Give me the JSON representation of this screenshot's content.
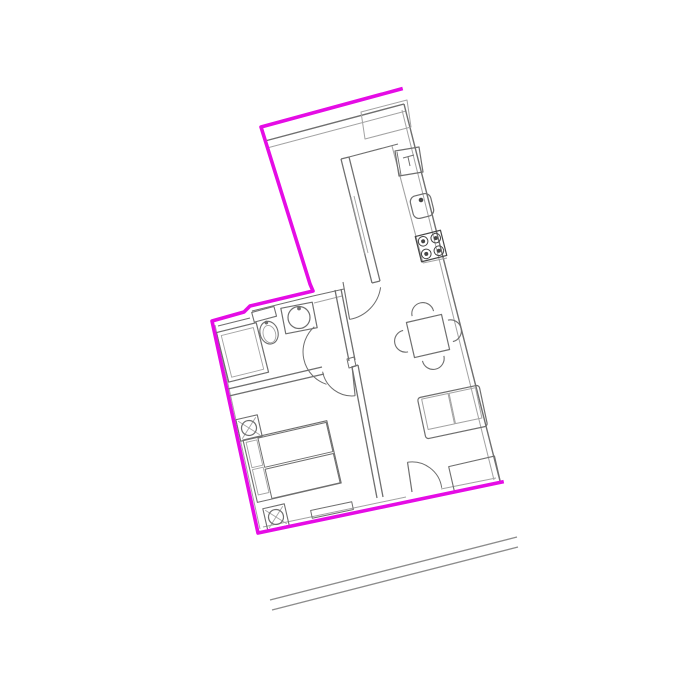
{
  "canvas": {
    "width": 700,
    "height": 700,
    "background": "#ffffff"
  },
  "palette": {
    "boundary": "#e50ce5",
    "wall": "#6f6f6f",
    "light": "#a3a3a3",
    "detail": "#454545",
    "road": "#8c8c8c"
  },
  "drawing_title": "Apartment floor plan",
  "shapes": [
    {
      "n": "road-line-outer",
      "t": "line",
      "p": [
        270,
        600,
        517,
        537
      ],
      "c": "road",
      "w": 1.4
    },
    {
      "n": "road-line-inner",
      "t": "line",
      "p": [
        272,
        610,
        518,
        547
      ],
      "c": "road",
      "w": 1.4
    },
    {
      "n": "top-wall-inner-dark",
      "t": "line",
      "p": [
        265,
        141,
        404,
        104
      ],
      "c": "wall",
      "w": 1.4
    },
    {
      "n": "top-wall-inner-light",
      "t": "line",
      "p": [
        267,
        148,
        406,
        111
      ],
      "c": "light",
      "w": 1
    },
    {
      "n": "upper-left-wall-inner",
      "t": "line",
      "p": [
        266,
        144,
        312,
        287
      ],
      "c": "light",
      "w": 1
    },
    {
      "n": "right-wall-outer",
      "t": "line",
      "p": [
        404,
        104,
        500,
        481
      ],
      "c": "wall",
      "w": 1.4
    },
    {
      "n": "right-wall-inner",
      "t": "line",
      "p": [
        402,
        110,
        494,
        480
      ],
      "c": "light",
      "w": 1
    },
    {
      "n": "bottom-wall-inner-left",
      "t": "line",
      "p": [
        263,
        527,
        406,
        497
      ],
      "c": "light",
      "w": 1
    },
    {
      "n": "bottom-wall-inner-right",
      "t": "line",
      "p": [
        441,
        489,
        496,
        478
      ],
      "c": "light",
      "w": 1
    },
    {
      "n": "left-wall-inner",
      "t": "line",
      "p": [
        215,
        325,
        260,
        529
      ],
      "c": "light",
      "w": 1
    },
    {
      "n": "bathroom-top-wall-inner",
      "t": "line",
      "p": [
        252,
        311,
        313,
        296
      ],
      "c": "wall",
      "w": 1
    },
    {
      "n": "bathroom-top-wall-inner-left",
      "t": "line",
      "p": [
        218,
        326,
        250,
        318
      ],
      "c": "wall",
      "w": 1
    },
    {
      "n": "bathroom-top-wall-east",
      "t": "line",
      "p": [
        313,
        296,
        344,
        289
      ],
      "c": "wall",
      "w": 1
    },
    {
      "n": "bathroom-top-wall-east-2",
      "t": "line",
      "p": [
        314,
        303,
        342,
        296
      ],
      "c": "light",
      "w": 1
    },
    {
      "n": "bathroom-east-wall-1",
      "t": "line",
      "p": [
        335,
        290,
        349,
        361
      ],
      "c": "wall",
      "w": 1.3
    },
    {
      "n": "bathroom-east-wall-2",
      "t": "line",
      "p": [
        341,
        289,
        355,
        360
      ],
      "c": "wall",
      "w": 1.3
    },
    {
      "n": "kitchen-wall-west",
      "t": "line",
      "p": [
        341,
        159,
        372,
        283
      ],
      "c": "wall",
      "w": 1.3
    },
    {
      "n": "kitchen-wall-east",
      "t": "line",
      "p": [
        349,
        157,
        380,
        281
      ],
      "c": "wall",
      "w": 1.3
    },
    {
      "n": "kitchen-wall-cap-top",
      "t": "line",
      "p": [
        341,
        159,
        349,
        157
      ],
      "c": "wall",
      "w": 1.3
    },
    {
      "n": "kitchen-wall-cap-bottom",
      "t": "line",
      "p": [
        372,
        283,
        380,
        281
      ],
      "c": "wall",
      "w": 1.3
    },
    {
      "n": "kitchen-wall-hatch-1",
      "t": "line",
      "p": [
        351,
        197,
        365,
        254
      ],
      "c": "light",
      "w": 0.9
    },
    {
      "n": "kitchen-wall-hatch-2",
      "t": "line",
      "p": [
        354,
        196,
        368,
        253
      ],
      "c": "light",
      "w": 0.9
    },
    {
      "n": "kitchen-counter-back-line",
      "t": "line",
      "p": [
        349,
        157,
        398,
        144
      ],
      "c": "wall",
      "w": 1.1
    },
    {
      "n": "kitchen-tall-unit",
      "t": "polygon",
      "pts": "361,112 407,100 411,127 365,139",
      "c": "light",
      "w": 1
    },
    {
      "n": "kitchen-counter-front",
      "t": "line",
      "p": [
        392,
        146,
        423,
        263
      ],
      "c": "light",
      "w": 1.1
    },
    {
      "n": "kitchen-counter-cap",
      "t": "line",
      "p": [
        423,
        263,
        447,
        258
      ],
      "c": "light",
      "w": 1.1
    },
    {
      "n": "appliance-boiler",
      "t": "polygon",
      "pts": "395,151 419,147 423,172 399,176",
      "c": "wall",
      "w": 1.2
    },
    {
      "n": "boiler-door-edge",
      "t": "line",
      "p": [
        397,
        152,
        401,
        175
      ],
      "c": "wall",
      "w": 0.9
    },
    {
      "n": "boiler-symbol-1",
      "t": "line",
      "p": [
        403,
        158,
        414,
        155
      ],
      "c": "wall",
      "w": 1
    },
    {
      "n": "boiler-symbol-2",
      "t": "line",
      "p": [
        408,
        157,
        410,
        166
      ],
      "c": "wall",
      "w": 1
    },
    {
      "n": "kitchen-sink",
      "t": "rect",
      "x": 411.5,
      "y": 194.5,
      "wd": 21,
      "h": 23,
      "rx": 6,
      "tr": "rotate(-14 422 206)",
      "c": "wall",
      "w": 1.2
    },
    {
      "n": "kitchen-sink-faucet",
      "t": "circle",
      "cx": 421,
      "cy": 200,
      "r": 1.8,
      "c": "detail",
      "w": 1,
      "f": "detail"
    },
    {
      "n": "stove",
      "t": "rect",
      "x": 418,
      "y": 233,
      "wd": 26,
      "h": 26,
      "tr": "rotate(-14 431 246)",
      "c": "detail",
      "w": 1.2
    },
    {
      "n": "stove-burner-1",
      "t": "circle",
      "cx": 424.5,
      "cy": 239.5,
      "r": 4.8,
      "tr": "rotate(-14 431 246)",
      "c": "detail",
      "w": 1
    },
    {
      "n": "stove-burner-2",
      "t": "circle",
      "cx": 437.5,
      "cy": 239.5,
      "r": 4.8,
      "tr": "rotate(-14 431 246)",
      "c": "detail",
      "w": 1
    },
    {
      "n": "stove-burner-3",
      "t": "circle",
      "cx": 424.5,
      "cy": 252.5,
      "r": 4.8,
      "tr": "rotate(-14 431 246)",
      "c": "detail",
      "w": 1
    },
    {
      "n": "stove-burner-4",
      "t": "circle",
      "cx": 437.5,
      "cy": 252.5,
      "r": 4.8,
      "tr": "rotate(-14 431 246)",
      "c": "detail",
      "w": 1
    },
    {
      "n": "stove-burner-dot-1",
      "t": "circle",
      "cx": 424.5,
      "cy": 239.5,
      "r": 1.6,
      "tr": "rotate(-14 431 246)",
      "c": "detail",
      "w": 0.8,
      "f": "detail"
    },
    {
      "n": "stove-burner-dot-2",
      "t": "circle",
      "cx": 437.5,
      "cy": 239.5,
      "r": 1.6,
      "tr": "rotate(-14 431 246)",
      "c": "detail",
      "w": 0.8,
      "f": "detail"
    },
    {
      "n": "stove-burner-dot-3",
      "t": "circle",
      "cx": 424.5,
      "cy": 252.5,
      "r": 1.6,
      "tr": "rotate(-14 431 246)",
      "c": "detail",
      "w": 0.8,
      "f": "detail"
    },
    {
      "n": "stove-burner-dot-4",
      "t": "circle",
      "cx": 437.5,
      "cy": 252.5,
      "r": 1.6,
      "tr": "rotate(-14 431 246)",
      "c": "detail",
      "w": 0.8,
      "f": "detail"
    },
    {
      "n": "hall-door-leaf",
      "t": "line",
      "p": [
        343,
        282,
        349.6,
        319.4
      ],
      "c": "wall",
      "w": 1.1
    },
    {
      "n": "hall-door-arc",
      "t": "path",
      "d": "M349.6,319.4 A38,38 0 0 0 380.6,287.3",
      "c": "wall",
      "w": 1
    },
    {
      "n": "bathroom-door-arc",
      "t": "path",
      "d": "M314.3,326.7 A34,34 0 0 0 326.5,384.3",
      "c": "wall",
      "w": 1
    },
    {
      "n": "bedroom-top-wall-1",
      "t": "line",
      "p": [
        228,
        389,
        322,
        367
      ],
      "c": "wall",
      "w": 1.3
    },
    {
      "n": "bedroom-top-wall-2",
      "t": "line",
      "p": [
        229,
        396,
        324,
        374
      ],
      "c": "wall",
      "w": 1.3
    },
    {
      "n": "bedroom-door-post",
      "t": "polygon",
      "pts": "347,359 354,357 356,366 349,368",
      "c": "wall",
      "w": 1
    },
    {
      "n": "bedroom-door-arc",
      "t": "path",
      "d": "M322.6,371.7 A30,30 0 0 0 355.1,395.8",
      "c": "wall",
      "w": 1
    },
    {
      "n": "bedroom-door-leaf",
      "t": "line",
      "p": [
        352,
        366,
        355.1,
        395.8
      ],
      "c": "wall",
      "w": 1.1
    },
    {
      "n": "bedroom-living-wall-1",
      "t": "line",
      "p": [
        352,
        367,
        377,
        498
      ],
      "c": "wall",
      "w": 1.3
    },
    {
      "n": "bedroom-living-wall-2",
      "t": "line",
      "p": [
        358,
        365,
        383,
        497
      ],
      "c": "wall",
      "w": 1.3
    },
    {
      "n": "bedroom-living-wall-cap",
      "t": "line",
      "p": [
        352,
        367,
        358,
        365
      ],
      "c": "wall",
      "w": 1.3
    },
    {
      "n": "shower-outer",
      "t": "rect",
      "x": 222,
      "y": 327,
      "wd": 41,
      "h": 51,
      "tr": "rotate(-14 242 352.5)",
      "c": "wall",
      "w": 1.2
    },
    {
      "n": "shower-inner",
      "t": "rect",
      "x": 226,
      "y": 331,
      "wd": 33,
      "h": 43,
      "tr": "rotate(-14 242 352.5)",
      "c": "light",
      "w": 0.9
    },
    {
      "n": "toilet-tank",
      "t": "rect",
      "x": 256,
      "y": 309,
      "wd": 23,
      "h": 10,
      "tr": "rotate(-15 267 327)",
      "c": "wall",
      "w": 1.1
    },
    {
      "n": "toilet-flush-dot",
      "t": "circle",
      "cx": 267.5,
      "cy": 322.5,
      "r": 1.5,
      "tr": "rotate(-15 267 327)",
      "c": "wall",
      "w": 0.8,
      "f": "wall"
    },
    {
      "n": "toilet-bowl",
      "t": "ellipse",
      "cx": 267.5,
      "cy": 333,
      "rx": 9,
      "ry": 11.5,
      "tr": "rotate(-15 267 327)",
      "c": "wall",
      "w": 1.1
    },
    {
      "n": "toilet-bowl-inner",
      "t": "ellipse",
      "cx": 267.5,
      "cy": 334.5,
      "rx": 6.2,
      "ry": 8.8,
      "tr": "rotate(-15 267 327)",
      "c": "light",
      "w": 0.9
    },
    {
      "n": "bath-sink-box",
      "t": "rect",
      "x": 283,
      "y": 305,
      "wd": 32,
      "h": 26,
      "tr": "rotate(-11 299 318)",
      "c": "wall",
      "w": 1.2
    },
    {
      "n": "bath-sink-basin",
      "t": "circle",
      "cx": 299,
      "cy": 317.5,
      "r": 11,
      "c": "wall",
      "w": 1.2
    },
    {
      "n": "bath-sink-faucet",
      "t": "circle",
      "cx": 299,
      "cy": 308.5,
      "r": 1.5,
      "c": "wall",
      "w": 0.8,
      "f": "wall"
    },
    {
      "n": "dining-table",
      "t": "rect",
      "x": 410,
      "y": 318,
      "wd": 36,
      "h": 36,
      "tr": "rotate(-13 428 336)",
      "c": "wall",
      "w": 1.2
    },
    {
      "n": "chair-north",
      "t": "path",
      "d": "M417,313 A11,11 0 0 1 439,313",
      "tr": "rotate(-13 428 336)",
      "c": "wall",
      "w": 1.1
    },
    {
      "n": "chair-south",
      "t": "path",
      "d": "M439,359 A11,11 0 0 1 417,359",
      "tr": "rotate(-13 428 336)",
      "c": "wall",
      "w": 1.1
    },
    {
      "n": "chair-west",
      "t": "path",
      "d": "M405,347 A11,11 0 0 1 405,325",
      "tr": "rotate(-13 428 336)",
      "c": "wall",
      "w": 1.1
    },
    {
      "n": "chair-east",
      "t": "path",
      "d": "M451,325 A11,11 0 0 1 451,347",
      "tr": "rotate(-13 428 336)",
      "c": "wall",
      "w": 1.1
    },
    {
      "n": "sofa-outer",
      "t": "rect",
      "x": 421,
      "y": 391,
      "wd": 63,
      "h": 42,
      "rx": 3,
      "tr": "rotate(-12 452.5 412)",
      "c": "wall",
      "w": 1.2
    },
    {
      "n": "sofa-cushion-1",
      "t": "rect",
      "x": 425,
      "y": 393,
      "wd": 27,
      "h": 31,
      "tr": "rotate(-12 452.5 412)",
      "c": "light",
      "w": 1
    },
    {
      "n": "sofa-cushion-2",
      "t": "rect",
      "x": 453,
      "y": 393,
      "wd": 27,
      "h": 31,
      "tr": "rotate(-12 452.5 412)",
      "c": "light",
      "w": 1
    },
    {
      "n": "sideboard",
      "t": "rect",
      "x": 451,
      "y": 461,
      "wd": 47,
      "h": 26,
      "tr": "rotate(-13 474.5 474)",
      "c": "wall",
      "w": 1.1
    },
    {
      "n": "entry-door-leaf",
      "t": "line",
      "p": [
        407.5,
        462.2,
        412,
        492
      ],
      "c": "wall",
      "w": 1.2
    },
    {
      "n": "entry-door-arc",
      "t": "path",
      "d": "M407.5,462.2 A30,30 0 0 1 441.7,487.8",
      "c": "wall",
      "w": 1
    },
    {
      "n": "bedroom-window",
      "t": "rect",
      "x": 311,
      "y": 506,
      "wd": 42,
      "h": 8,
      "tr": "rotate(-12 332 510)",
      "c": "wall",
      "w": 1
    },
    {
      "n": "bed-frame",
      "t": "rect",
      "x": 243,
      "y": 440,
      "wd": 86,
      "h": 64,
      "tr": "rotate(-13 243 440)",
      "c": "wall",
      "w": 1.1
    },
    {
      "n": "bed-mattress-1",
      "t": "rect",
      "x": 258,
      "y": 441.5,
      "wd": 70,
      "h": 30,
      "tr": "rotate(-13 243 440)",
      "c": "wall",
      "w": 1
    },
    {
      "n": "bed-mattress-2",
      "t": "rect",
      "x": 258,
      "y": 473.5,
      "wd": 70,
      "h": 30,
      "tr": "rotate(-13 243 440)",
      "c": "wall",
      "w": 1
    },
    {
      "n": "bed-pillow-1",
      "t": "rect",
      "x": 245.5,
      "y": 443,
      "wd": 11,
      "h": 26,
      "tr": "rotate(-13 243 440)",
      "c": "light",
      "w": 0.9
    },
    {
      "n": "bed-pillow-2",
      "t": "rect",
      "x": 245.5,
      "y": 471,
      "wd": 11,
      "h": 26,
      "tr": "rotate(-13 243 440)",
      "c": "light",
      "w": 0.9
    },
    {
      "n": "nightstand-1",
      "t": "rect",
      "x": 238,
      "y": 417,
      "wd": 22,
      "h": 22,
      "tr": "rotate(-13 249 428)",
      "c": "wall",
      "w": 1.1
    },
    {
      "n": "nightstand-1-lamp-x1",
      "t": "line",
      "p": [
        240,
        419,
        258,
        437
      ],
      "tr": "rotate(-13 249 428)",
      "c": "light",
      "w": 0.9
    },
    {
      "n": "nightstand-1-lamp-x2",
      "t": "line",
      "p": [
        258,
        419,
        240,
        437
      ],
      "tr": "rotate(-13 249 428)",
      "c": "light",
      "w": 0.9
    },
    {
      "n": "nightstand-1-lamp-circle",
      "t": "circle",
      "cx": 249,
      "cy": 428,
      "r": 7.5,
      "tr": "rotate(-13 249 428)",
      "c": "wall",
      "w": 1.2
    },
    {
      "n": "nightstand-2",
      "t": "rect",
      "x": 265,
      "y": 506,
      "wd": 22,
      "h": 22,
      "tr": "rotate(-13 276 517)",
      "c": "wall",
      "w": 1.1
    },
    {
      "n": "nightstand-2-lamp-x1",
      "t": "line",
      "p": [
        267,
        508,
        285,
        526
      ],
      "tr": "rotate(-13 276 517)",
      "c": "light",
      "w": 0.9
    },
    {
      "n": "nightstand-2-lamp-x2",
      "t": "line",
      "p": [
        285,
        508,
        267,
        526
      ],
      "tr": "rotate(-13 276 517)",
      "c": "light",
      "w": 0.9
    },
    {
      "n": "nightstand-2-lamp-circle",
      "t": "circle",
      "cx": 276,
      "cy": 517,
      "r": 7.5,
      "tr": "rotate(-13 276 517)",
      "c": "wall",
      "w": 1.2
    },
    {
      "n": "apartment-boundary",
      "t": "polyline",
      "pts": "401,89 261,127 310,284 313,291 250,306 244,312 212,321 258,533 502,482",
      "c": "boundary",
      "w": 3.6
    }
  ]
}
